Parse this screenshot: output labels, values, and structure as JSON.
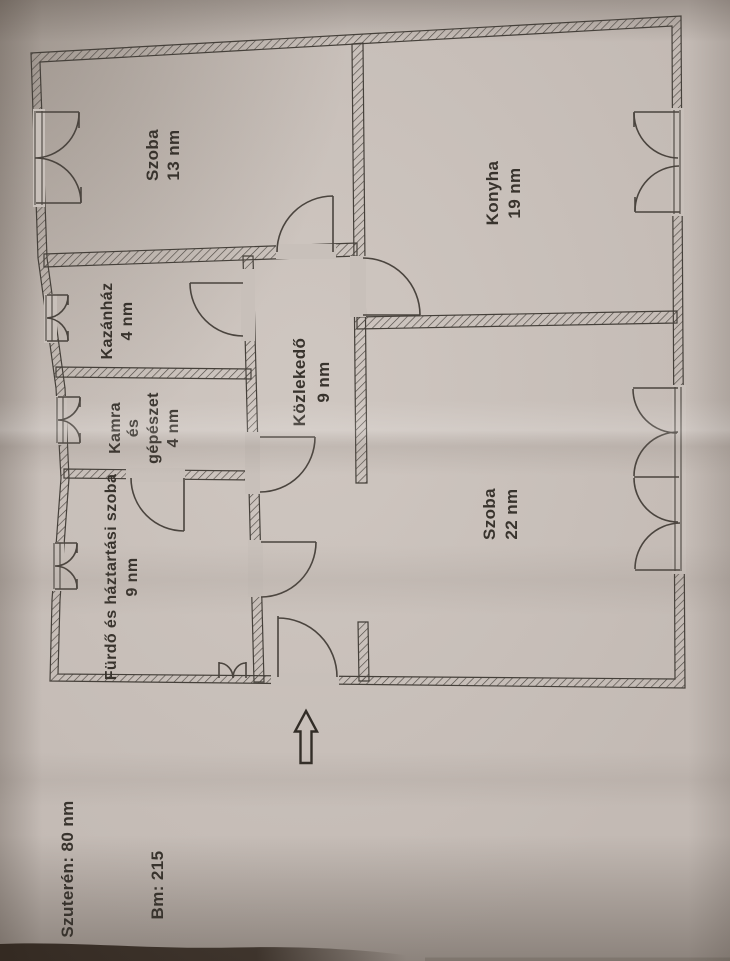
{
  "rooms": {
    "szoba13": {
      "name": "Szoba",
      "area": "13 nm"
    },
    "konyha": {
      "name": "Konyha",
      "area": "19 nm"
    },
    "kazanhaz": {
      "name": "Kazánház",
      "area": "4 nm"
    },
    "kamra": {
      "name_line1": "Kamra",
      "name_line2": "és",
      "name_line3": "gépészet",
      "area": "4 nm"
    },
    "kozlekedo": {
      "name": "Közlekedő",
      "area": "9 nm"
    },
    "furdo": {
      "name": "Fürdő és háztartási szoba",
      "area": "9 nm"
    },
    "szoba22": {
      "name": "Szoba",
      "area": "22 nm"
    }
  },
  "annotations": {
    "basement": "Szuterén: 80 nm",
    "building_height": "Bm: 215"
  },
  "icons": {
    "north_arrow": "north-arrow-icon"
  },
  "colors": {
    "paper": "#c8c0ba",
    "ink": "#38332d",
    "wall_hatch": "#4f4a44",
    "shadow_strip": "#30261e"
  }
}
